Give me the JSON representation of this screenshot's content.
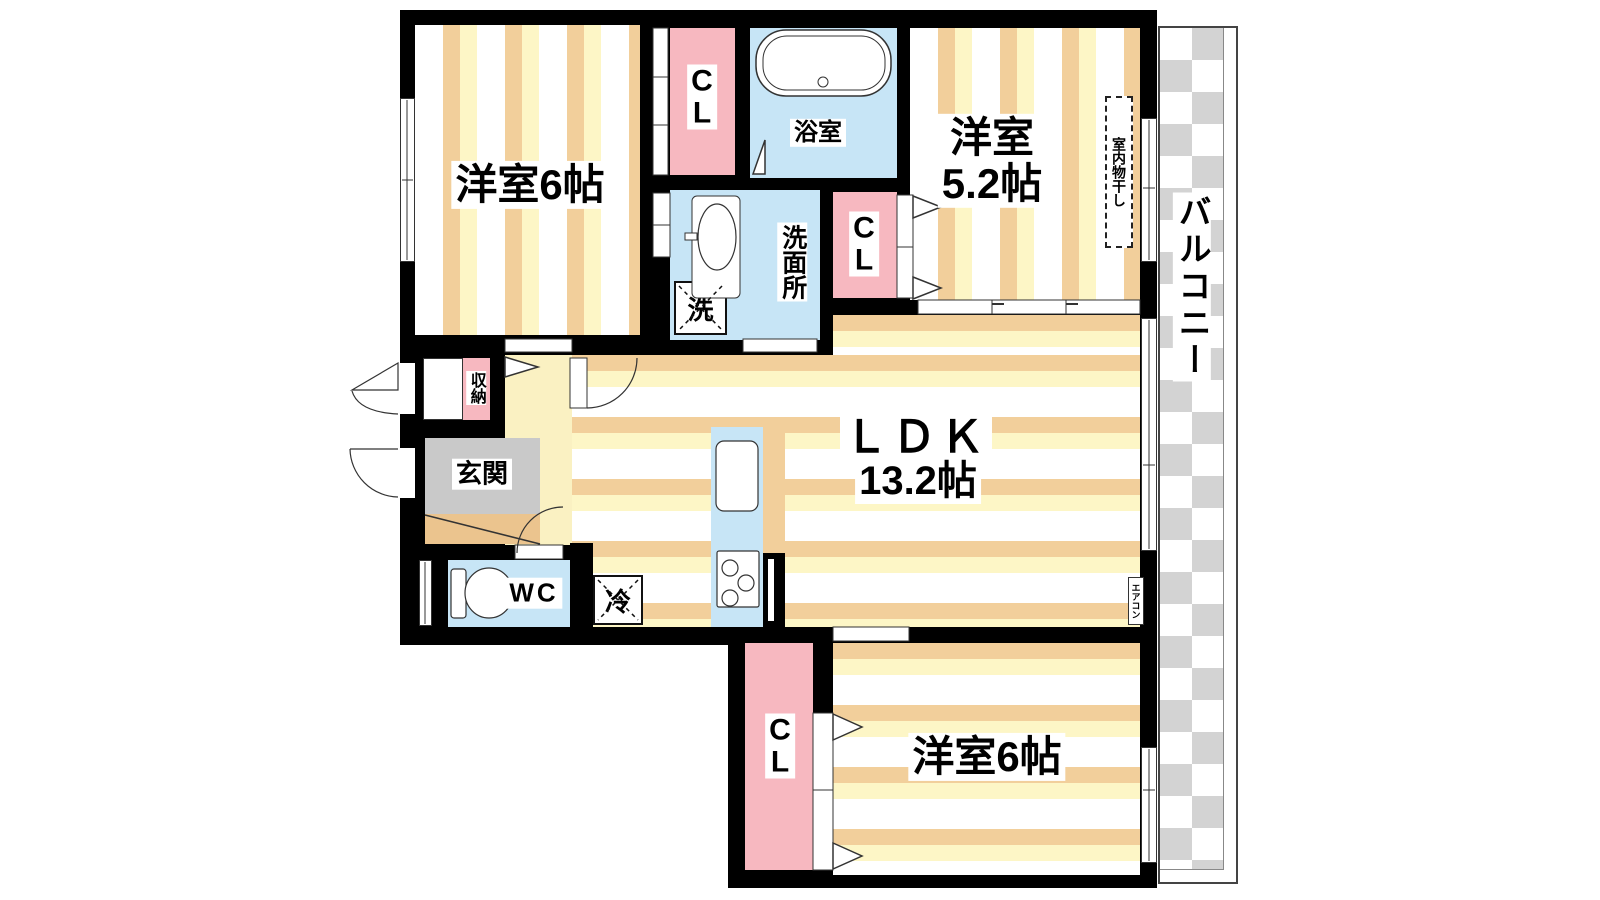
{
  "plan": {
    "rooms": {
      "western_room_top": {
        "label": "洋室6帖"
      },
      "western_room_right": {
        "line1": "洋室",
        "line2": "5.2帖"
      },
      "ldk": {
        "line1": "ＬＤＫ",
        "line2": "13.2帖"
      },
      "western_room_bottom": {
        "label": "洋室6帖"
      },
      "bathroom": {
        "label": "浴室"
      },
      "washroom": {
        "label": "洗面所"
      },
      "toilet": {
        "label": "WC"
      },
      "entrance": {
        "label": "玄関"
      },
      "storage": {
        "label": "収納"
      },
      "closet": {
        "letter1": "C",
        "letter2": "L"
      },
      "balcony": {
        "label": "バルコニー"
      }
    },
    "fixtures": {
      "washing_machine": {
        "label": "洗"
      },
      "refrigerator": {
        "label": "冷"
      },
      "indoor_drying": {
        "label": "室内物干し"
      },
      "air_conditioner": {
        "label": "エアコン"
      }
    },
    "colors": {
      "wall": "#000000",
      "stripe_tan": "#F2CF9B",
      "stripe_cream": "#FDF6C6",
      "closet_pink": "#F7B8C0",
      "water_blue": "#C7E5F6",
      "hall_yellow": "#FAF1C2",
      "entrance_gray": "#C9C9C9",
      "step_tan": "#EBC48E",
      "balcony_checker_gray": "#D3D3D3"
    }
  }
}
